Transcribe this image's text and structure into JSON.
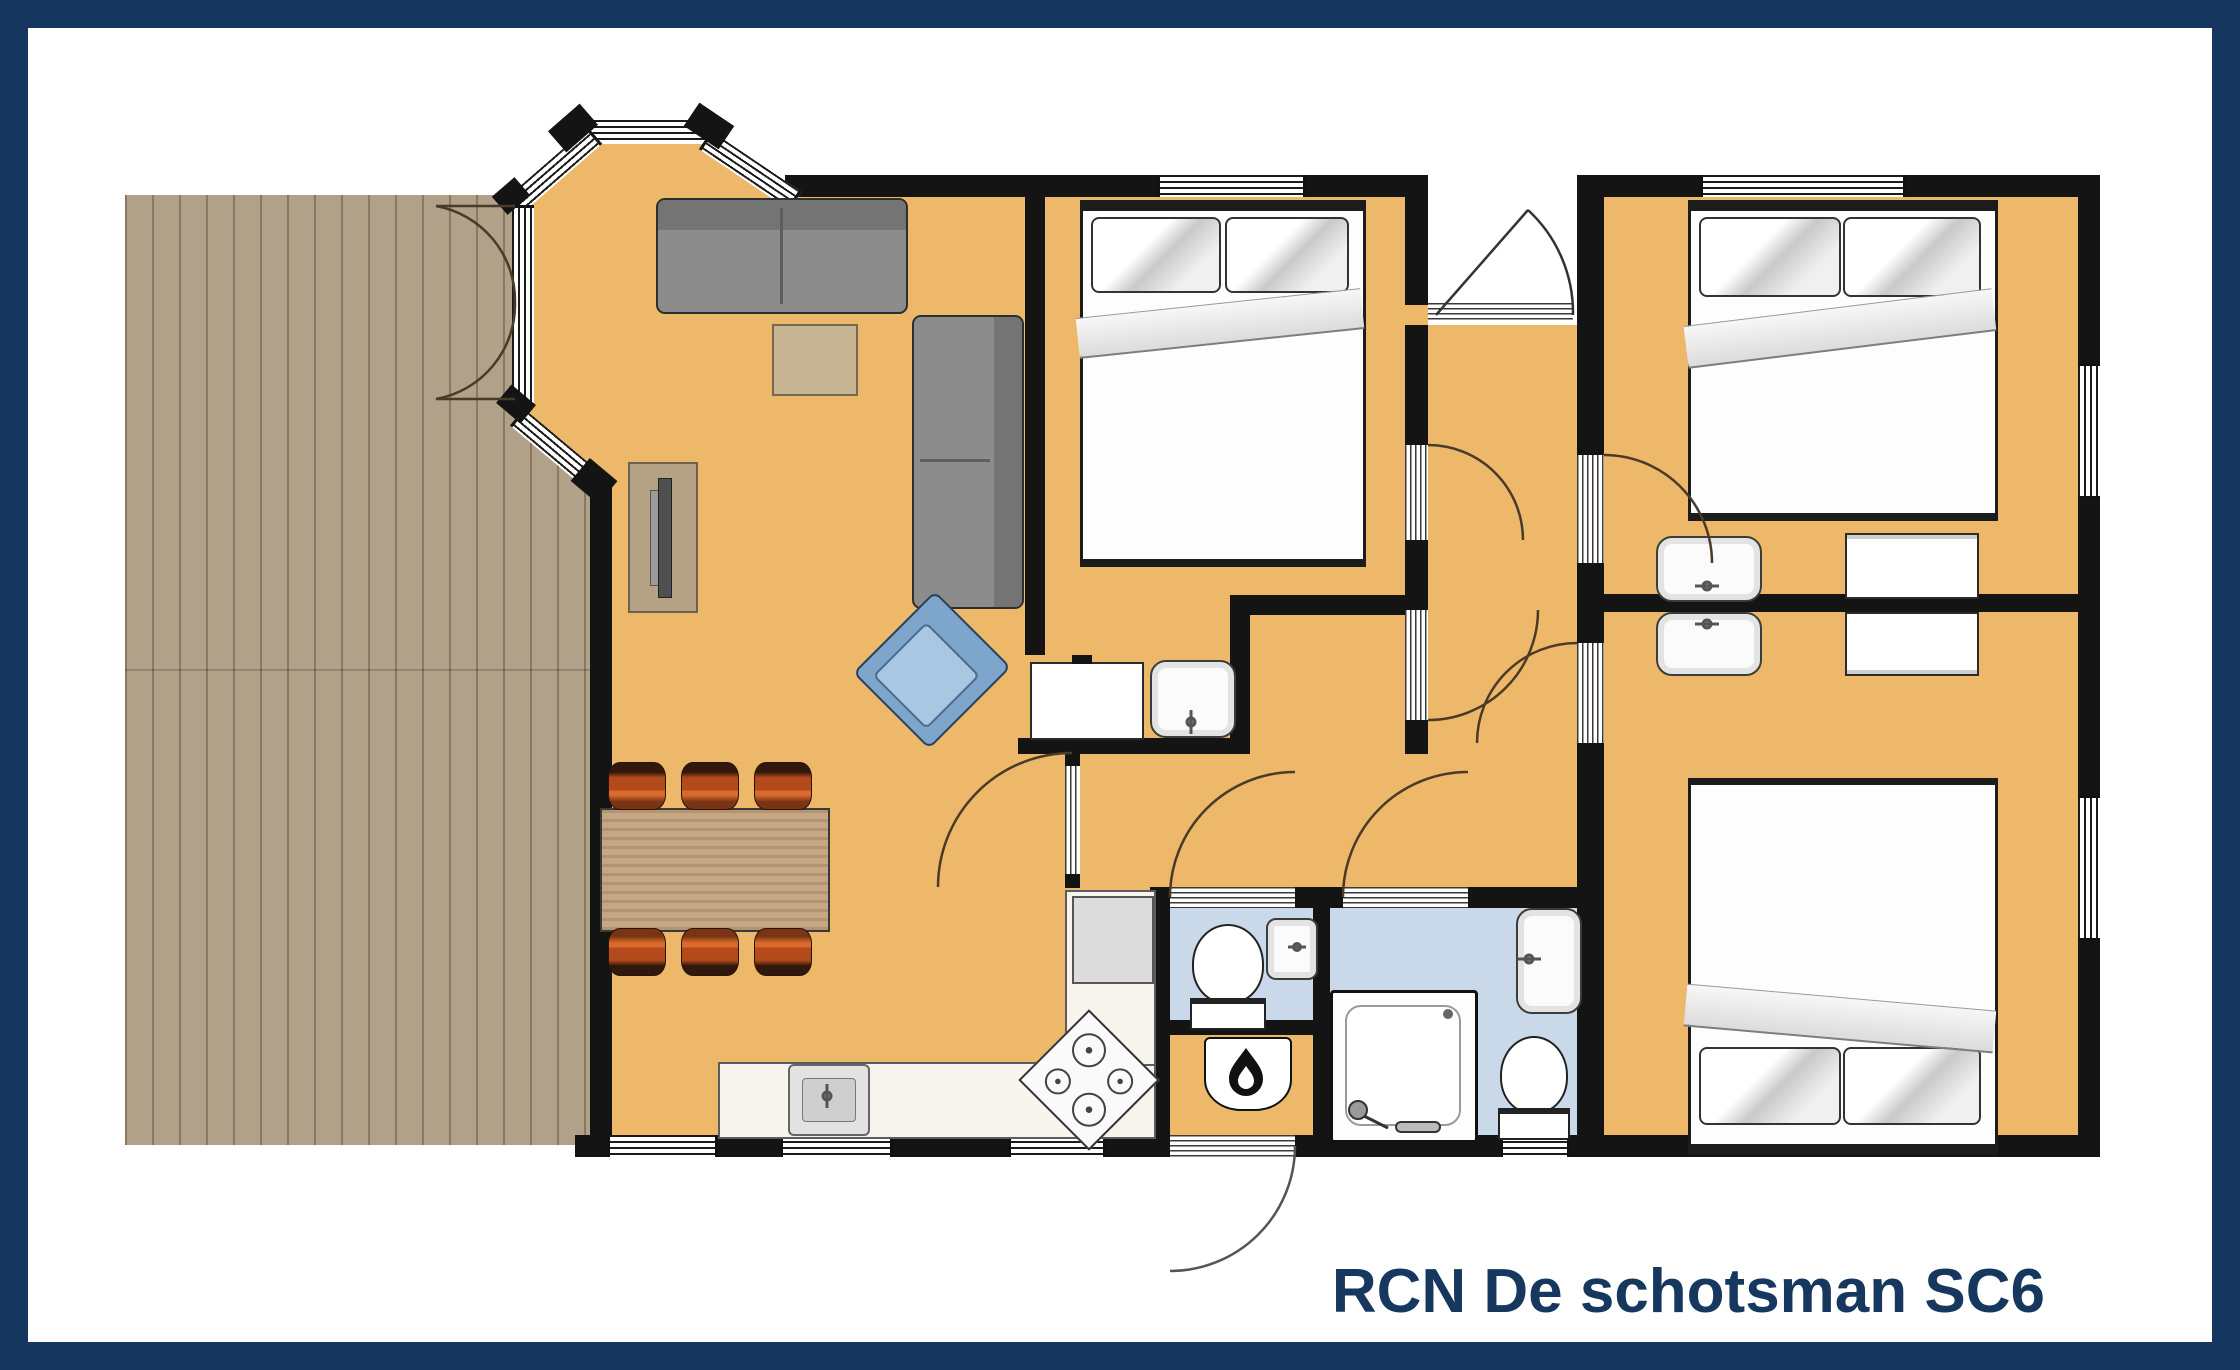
{
  "title": {
    "text": "RCN De schotsman SC6"
  },
  "colors": {
    "frame_navy": "#15365f",
    "title_navy": "#16375e",
    "wall_black": "#141414",
    "floor_orange": "#edb869",
    "wet_room_blue": "#c9d9e9",
    "deck_wood": "#b2a189",
    "sofa_gray": "#8c8c8c",
    "armchair_blue": "#7ea6cc",
    "dining_chair_orange": "#b34a1c",
    "table_wood": "#c6a784",
    "counter_cream": "#f6f4ed"
  },
  "rooms": [
    "deck-terrace",
    "living-room",
    "dining-area",
    "kitchen",
    "bedroom-1",
    "bedroom-2",
    "bedroom-3",
    "hallway",
    "corridor",
    "toilet-room",
    "bathroom",
    "boiler-closet",
    "entrance-recess"
  ],
  "furniture": [
    "sofa",
    "loveseat",
    "tv-cabinet",
    "coffee-table",
    "armchair",
    "dining-table",
    "dining-chair",
    "double-bed",
    "pillow",
    "duvet",
    "dresser",
    "washbasin",
    "wardrobe",
    "fridge",
    "stove",
    "kitchen-sink",
    "toilet",
    "shower",
    "boiler"
  ]
}
